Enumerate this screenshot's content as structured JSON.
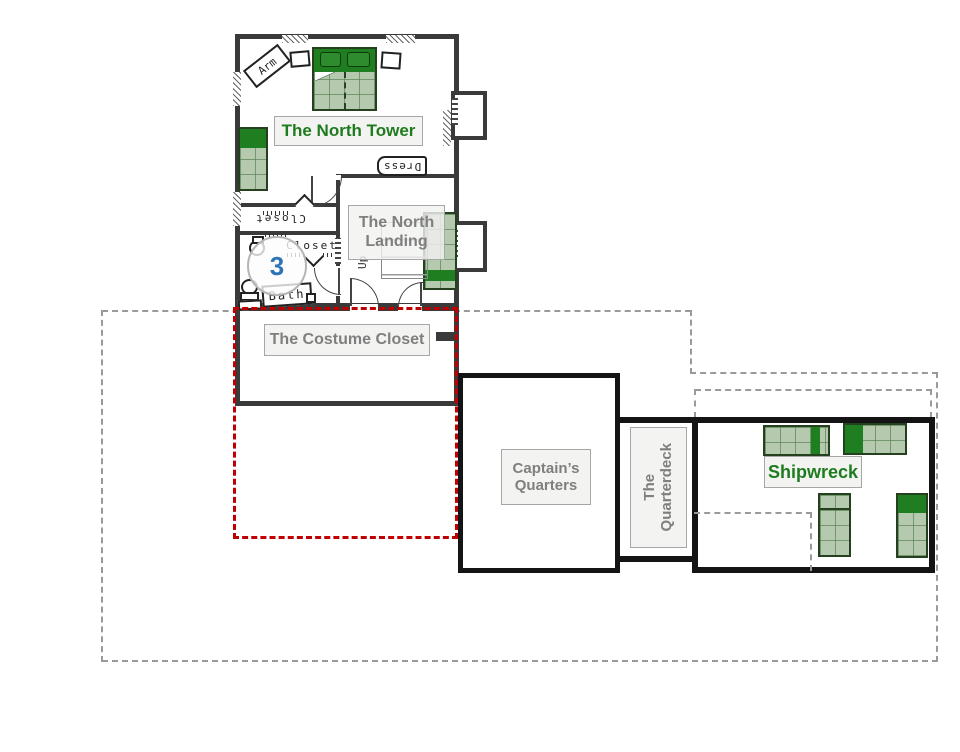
{
  "floorplan": {
    "rooms": {
      "north_tower": {
        "label": "The North Tower"
      },
      "north_landing": {
        "lines": [
          "The North",
          "Landing"
        ]
      },
      "costume_closet": {
        "label": "The Costume Closet"
      },
      "captains_quarters": {
        "lines": [
          "Captain’s",
          "Quarters"
        ]
      },
      "quarterdeck": {
        "lines": [
          "The",
          "Quarterdeck"
        ]
      },
      "shipwreck": {
        "label": "Shipwreck"
      }
    },
    "furniture_labels": {
      "armoire": "Arm",
      "dresser": "Dress",
      "closet_top": "Closet",
      "closet_mid": "Closet",
      "bath": "Bath",
      "stairs_up": "Up"
    },
    "marker": {
      "value": "3"
    },
    "colors": {
      "room_label_green": "#1e7b1e",
      "room_label_gray": "#7f7f7f",
      "marker_blue": "#2e74b5",
      "bed_light_green": "#b4c9ad",
      "bed_dark_green": "#1f7e1f",
      "wall_dark": "#3a3a3a",
      "wall_black": "#141414",
      "boundary_gray": "#9a9a9a",
      "selection_red": "#c00000"
    }
  }
}
